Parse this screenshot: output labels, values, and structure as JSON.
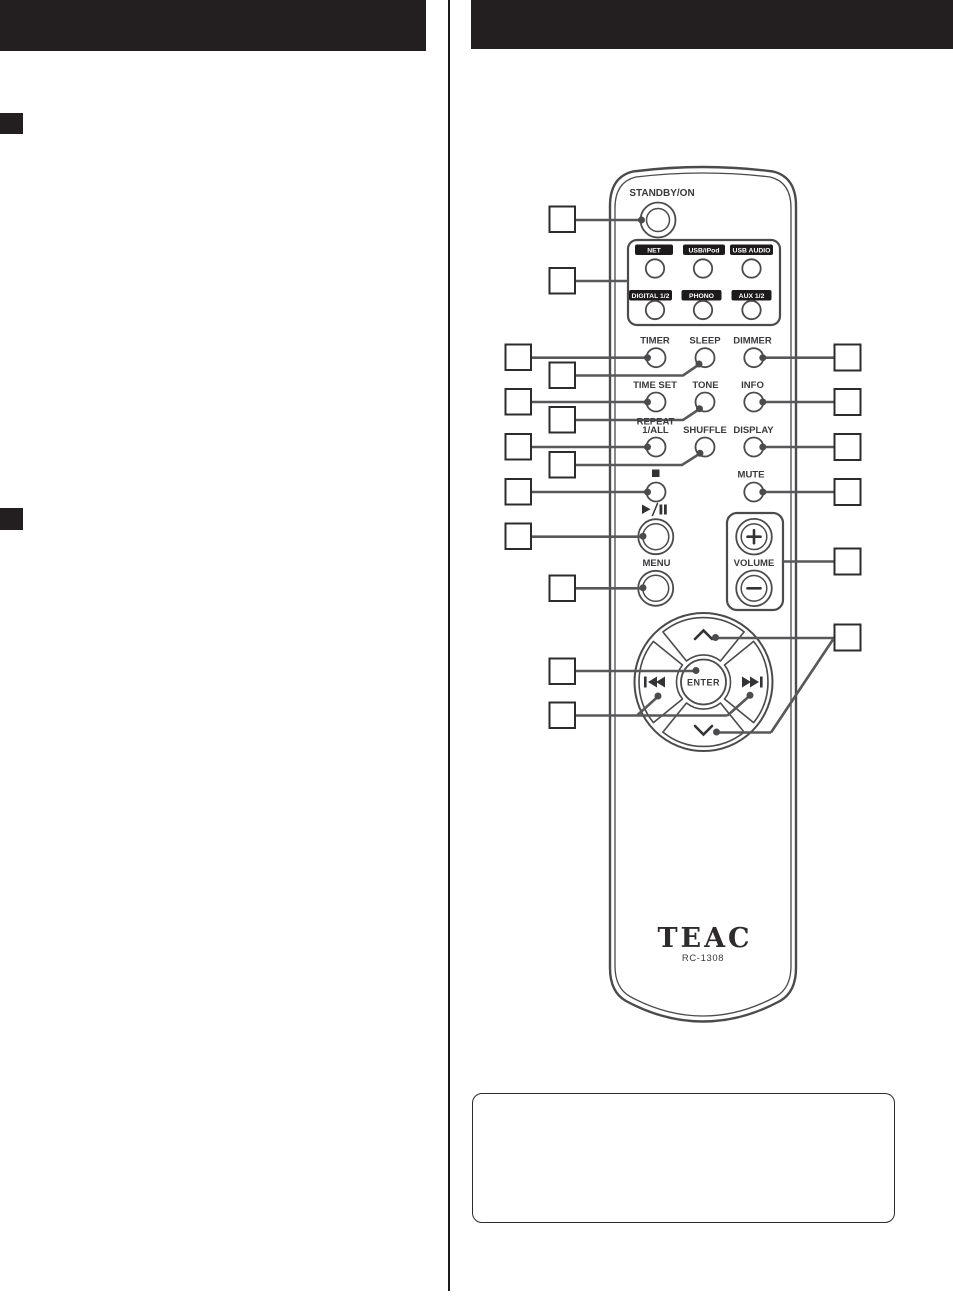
{
  "colors": {
    "header_bar": "#231f20",
    "illustration_stroke": "#4b4b4d",
    "leader_line": "#58585a",
    "source_label_box": "#1d1a1b"
  },
  "remote": {
    "brand": "TEAC",
    "model": "RC-1308",
    "labels": {
      "standby": "STANDBY/ON",
      "timer": "TIMER",
      "sleep": "SLEEP",
      "dimmer": "DIMMER",
      "time_set": "TIME SET",
      "tone": "TONE",
      "info": "INFO",
      "repeat_line1": "REPEAT",
      "repeat_line2": "1/ALL",
      "shuffle": "SHUFFLE",
      "display": "DISPLAY",
      "mute": "MUTE",
      "menu": "MENU",
      "volume": "VOLUME",
      "enter": "ENTER"
    },
    "sources": [
      {
        "label": "NET"
      },
      {
        "label": "USB/iPod"
      },
      {
        "label": "USB AUDIO"
      },
      {
        "label": "DIGITAL 1/2"
      },
      {
        "label": "PHONO"
      },
      {
        "label": "AUX 1/2"
      }
    ]
  }
}
